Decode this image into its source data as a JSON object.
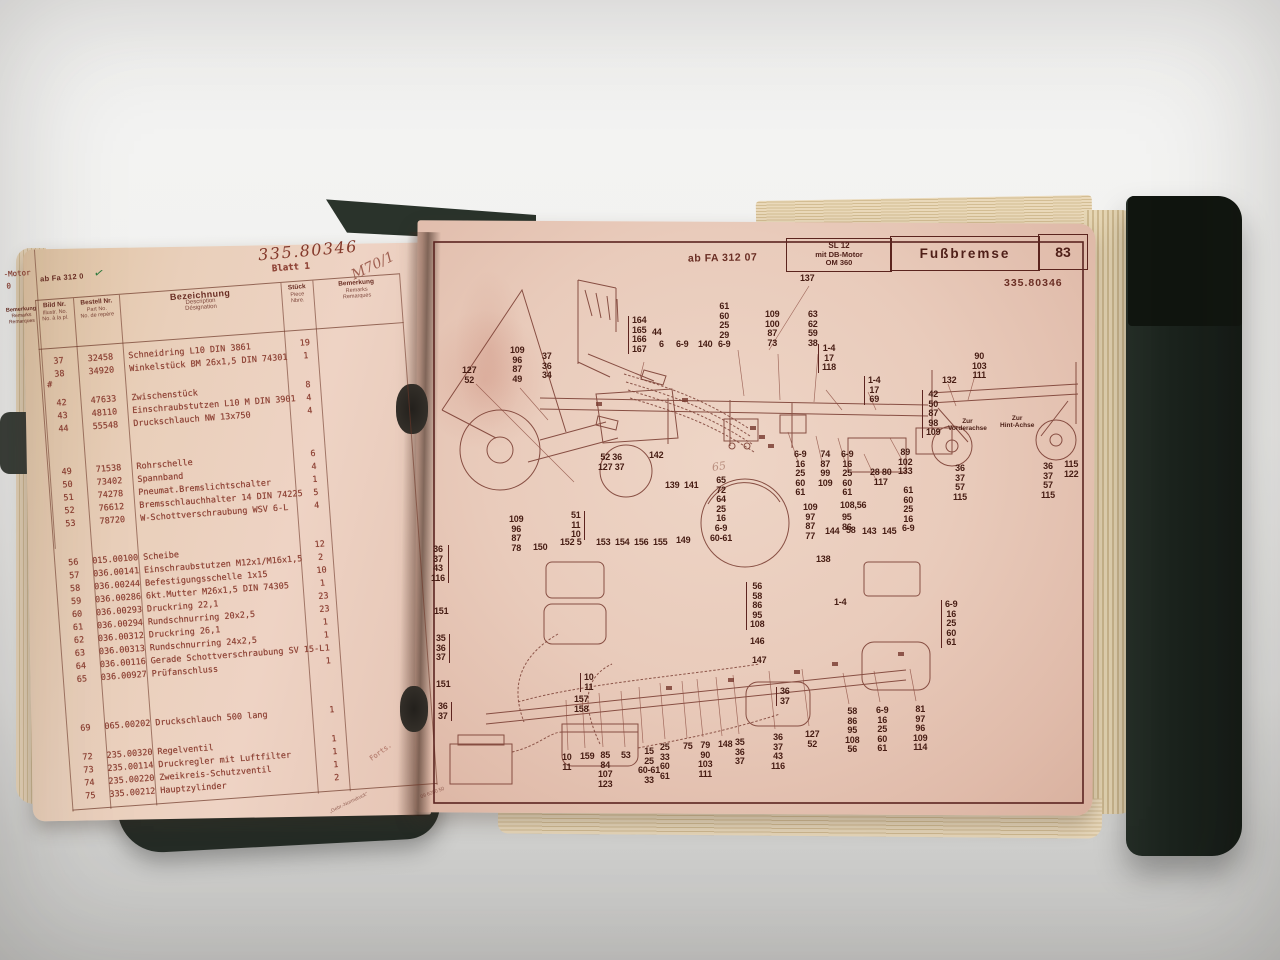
{
  "book": {
    "left_page": {
      "underlay": {
        "motor_fragment": "-Motor",
        "zero_fragment": "0",
        "bem_header": [
          "Bemerkung",
          "Remarks",
          "Remarques"
        ]
      },
      "handwritten_number": "335.80346",
      "sheet": "Blatt 1",
      "stamp": "ab Fa 312 0",
      "check_mark": "✓",
      "note": "M70/1",
      "stray_mark": "#",
      "table": {
        "headers": {
          "bild": [
            "Bild Nr.",
            "Illustr. No.",
            "No. à la pl."
          ],
          "bestell": [
            "Bestell Nr.",
            "Part No.",
            "No. de repère"
          ],
          "bezeichnung": [
            "Bezeichnung",
            "Description",
            "Désignation"
          ],
          "stueck": [
            "Stück",
            "Piece",
            "Nbre."
          ],
          "bemerkung": [
            "Bemerkung",
            "Remarks",
            "Remarques"
          ]
        },
        "rows": [
          {
            "bild": "37",
            "bestell": "32458",
            "name": "Schneidring L10 DIN 3861",
            "qty": "19"
          },
          {
            "bild": "38",
            "bestell": "34920",
            "name": "Winkelstück BM 26x1,5 DIN 74301",
            "qty": "1"
          },
          {
            "bild": "42",
            "bestell": "47633",
            "name": "Zwischenstück",
            "qty": "8",
            "gap": 16
          },
          {
            "bild": "43",
            "bestell": "48110",
            "name": "Einschraubstutzen L10 M DIN 3901",
            "qty": "4"
          },
          {
            "bild": "44",
            "bestell": "55548",
            "name": "Druckschlauch NW 13x750",
            "qty": "4"
          },
          {
            "bild": "49",
            "bestell": "71538",
            "name": "Rohrschelle",
            "qty": "6",
            "gap": 30
          },
          {
            "bild": "50",
            "bestell": "73402",
            "name": "Spannband",
            "qty": "4"
          },
          {
            "bild": "51",
            "bestell": "74278",
            "name": "Pneumat.Bremslichtschalter",
            "qty": "1"
          },
          {
            "bild": "52",
            "bestell": "76612",
            "name": "Bremsschlauchhalter 14 DIN 74225",
            "qty": "5"
          },
          {
            "bild": "53",
            "bestell": "78720",
            "name": "W-Schottverschraubung WSV 6-L",
            "qty": "4"
          },
          {
            "bild": "56",
            "bestell": "015.00100",
            "name": "Scheibe",
            "qty": "12",
            "gap": 26
          },
          {
            "bild": "57",
            "bestell": "036.00141",
            "name": "Einschraubstutzen M12x1/M16x1,5",
            "qty": "2"
          },
          {
            "bild": "58",
            "bestell": "036.00244",
            "name": "Befestigungsschelle 1x15",
            "qty": "10"
          },
          {
            "bild": "59",
            "bestell": "036.00286",
            "name": "6kt.Mutter M26x1,5 DIN 74305",
            "qty": "1"
          },
          {
            "bild": "60",
            "bestell": "036.00293",
            "name": "Druckring 22,1",
            "qty": "23"
          },
          {
            "bild": "61",
            "bestell": "036.00294",
            "name": "Rundschnurring 20x2,5",
            "qty": "23"
          },
          {
            "bild": "62",
            "bestell": "036.00312",
            "name": "Druckring 26,1",
            "qty": "1"
          },
          {
            "bild": "63",
            "bestell": "036.00313",
            "name": "Rundschnurring 24x2,5",
            "qty": "1"
          },
          {
            "bild": "64",
            "bestell": "036.00116",
            "name": "Gerade Schottverschraubung SV 15-L",
            "qty": "1"
          },
          {
            "bild": "65",
            "bestell": "036.00927",
            "name": "Prüfanschluss",
            "qty": "1"
          },
          {
            "bild": "69",
            "bestell": "065.00202",
            "name": "Druckschlauch 500 lang",
            "qty": "1",
            "gap": 36
          },
          {
            "bild": "72",
            "bestell": "235.00320",
            "name": "Regelventil",
            "qty": "1",
            "gap": 16
          },
          {
            "bild": "73",
            "bestell": "235.00114",
            "name": "Druckregler mit Luftfilter",
            "qty": "1"
          },
          {
            "bild": "74",
            "bestell": "235.00220",
            "name": "Zweikreis-Schutzventil",
            "qty": "1"
          },
          {
            "bild": "75",
            "bestell": "335.00212",
            "name": "Hauptzylinder",
            "qty": "2"
          }
        ]
      },
      "footer": {
        "continuation": "Forts.",
        "print_name": "„Gebr.-Normdruck“",
        "print_code": "09 6280 50"
      }
    },
    "right_page": {
      "stamp": "ab FA 312 07",
      "model_box": [
        "SL 12",
        "mit DB-Motor",
        "OM 360"
      ],
      "title": "Fußbremse",
      "page_number": "83",
      "doc_number": "335.80346",
      "diagram": {
        "ghost_note": "65",
        "axle_labels": [
          {
            "x": 520,
            "y": 186,
            "lines": [
              "Zur",
              "Vorderachse"
            ]
          },
          {
            "x": 572,
            "y": 183,
            "lines": [
              "Zur",
              "Hint-Achse"
            ]
          }
        ],
        "callouts": [
          {
            "x": 372,
            "y": 42,
            "lines": [
              "137"
            ]
          },
          {
            "x": 290,
            "y": 70,
            "lines": [
              "61",
              "60",
              "25",
              "29",
              "6-9"
            ]
          },
          {
            "x": 337,
            "y": 78,
            "lines": [
              "109",
              "100",
              "87",
              "73"
            ]
          },
          {
            "x": 380,
            "y": 78,
            "lines": [
              "63",
              "62",
              "59",
              "38"
            ]
          },
          {
            "x": 200,
            "y": 84,
            "lines": [
              "164",
              "165",
              "166",
              "167"
            ],
            "br": "left"
          },
          {
            "x": 224,
            "y": 96,
            "lines": [
              "44"
            ]
          },
          {
            "x": 231,
            "y": 108,
            "lines": [
              "6"
            ]
          },
          {
            "x": 248,
            "y": 108,
            "lines": [
              "6-9"
            ]
          },
          {
            "x": 270,
            "y": 108,
            "lines": [
              "140"
            ]
          },
          {
            "x": 82,
            "y": 114,
            "lines": [
              "109",
              "96",
              "87",
              "49"
            ]
          },
          {
            "x": 114,
            "y": 120,
            "lines": [
              "37",
              "36",
              "34"
            ]
          },
          {
            "x": 34,
            "y": 134,
            "lines": [
              "127",
              "52"
            ]
          },
          {
            "x": 390,
            "y": 112,
            "lines": [
              "1-4",
              "17",
              "118"
            ],
            "br": "left"
          },
          {
            "x": 436,
            "y": 144,
            "lines": [
              "1-4",
              "17",
              "69"
            ],
            "br": "left"
          },
          {
            "x": 544,
            "y": 120,
            "lines": [
              "90",
              "103",
              "111"
            ]
          },
          {
            "x": 514,
            "y": 144,
            "lines": [
              "132"
            ]
          },
          {
            "x": 494,
            "y": 158,
            "lines": [
              "42",
              "50",
              "87",
              "98",
              "109"
            ],
            "br": "left"
          },
          {
            "x": 366,
            "y": 218,
            "lines": [
              "6-9",
              "16",
              "25",
              "60",
              "61"
            ]
          },
          {
            "x": 390,
            "y": 218,
            "lines": [
              "74",
              "87",
              "99",
              "109"
            ]
          },
          {
            "x": 413,
            "y": 218,
            "lines": [
              "6-9",
              "16",
              "25",
              "60",
              "61"
            ]
          },
          {
            "x": 442,
            "y": 236,
            "lines": [
              "28 80",
              "117"
            ]
          },
          {
            "x": 470,
            "y": 216,
            "lines": [
              "89",
              "102",
              "133"
            ]
          },
          {
            "x": 170,
            "y": 221,
            "lines": [
              "52 36",
              "127 37"
            ]
          },
          {
            "x": 221,
            "y": 219,
            "lines": [
              "142"
            ]
          },
          {
            "x": 237,
            "y": 249,
            "lines": [
              "139  141"
            ]
          },
          {
            "x": 282,
            "y": 244,
            "lines": [
              "65",
              "72",
              "64",
              "25",
              "16",
              "6-9",
              "60-61"
            ]
          },
          {
            "x": 474,
            "y": 254,
            "lines": [
              "61",
              "60",
              "25",
              "16",
              "6-9"
            ]
          },
          {
            "x": 375,
            "y": 271,
            "lines": [
              "109",
              "97",
              "87",
              "77"
            ]
          },
          {
            "x": 412,
            "y": 269,
            "lines": [
              "108,56"
            ]
          },
          {
            "x": 414,
            "y": 281,
            "lines": [
              "95",
              "86"
            ]
          },
          {
            "x": 397,
            "y": 295,
            "lines": [
              "144"
            ]
          },
          {
            "x": 418,
            "y": 294,
            "lines": [
              "58"
            ]
          },
          {
            "x": 434,
            "y": 295,
            "lines": [
              "143"
            ]
          },
          {
            "x": 454,
            "y": 295,
            "lines": [
              "145"
            ]
          },
          {
            "x": 143,
            "y": 279,
            "lines": [
              "51",
              "11",
              "10"
            ],
            "br": "right"
          },
          {
            "x": 105,
            "y": 311,
            "lines": [
              "150"
            ]
          },
          {
            "x": 132,
            "y": 306,
            "lines": [
              "152 5"
            ]
          },
          {
            "x": 168,
            "y": 306,
            "lines": [
              "153  154  156  155"
            ]
          },
          {
            "x": 248,
            "y": 304,
            "lines": [
              "149"
            ]
          },
          {
            "x": 81,
            "y": 283,
            "lines": [
              "109",
              "96",
              "87",
              "78"
            ]
          },
          {
            "x": 3,
            "y": 313,
            "lines": [
              "36",
              "37",
              "43",
              "116"
            ],
            "br": "right"
          },
          {
            "x": 6,
            "y": 375,
            "lines": [
              "151"
            ]
          },
          {
            "x": 8,
            "y": 402,
            "lines": [
              "35",
              "36",
              "37"
            ],
            "br": "right"
          },
          {
            "x": 8,
            "y": 448,
            "lines": [
              "151"
            ]
          },
          {
            "x": 10,
            "y": 470,
            "lines": [
              "36",
              "37"
            ],
            "br": "right"
          },
          {
            "x": 388,
            "y": 323,
            "lines": [
              "138"
            ]
          },
          {
            "x": 318,
            "y": 350,
            "lines": [
              "56",
              "58",
              "86",
              "95",
              "108"
            ],
            "br": "left"
          },
          {
            "x": 406,
            "y": 366,
            "lines": [
              "1-4"
            ]
          },
          {
            "x": 513,
            "y": 368,
            "lines": [
              "6-9",
              "16",
              "25",
              "60",
              "61"
            ],
            "br": "left"
          },
          {
            "x": 322,
            "y": 405,
            "lines": [
              "146"
            ]
          },
          {
            "x": 324,
            "y": 424,
            "lines": [
              "147"
            ]
          },
          {
            "x": 152,
            "y": 441,
            "lines": [
              "10",
              "11"
            ],
            "br": "left"
          },
          {
            "x": 146,
            "y": 463,
            "lines": [
              "157",
              "158"
            ]
          },
          {
            "x": 348,
            "y": 455,
            "lines": [
              "36",
              "37"
            ],
            "br": "left"
          },
          {
            "x": 134,
            "y": 521,
            "lines": [
              "10",
              "11"
            ]
          },
          {
            "x": 152,
            "y": 520,
            "lines": [
              "159"
            ]
          },
          {
            "x": 170,
            "y": 519,
            "lines": [
              "85",
              "84",
              "107",
              "123"
            ]
          },
          {
            "x": 193,
            "y": 519,
            "lines": [
              "53"
            ]
          },
          {
            "x": 210,
            "y": 515,
            "lines": [
              "15",
              "25",
              "60-61",
              "33"
            ]
          },
          {
            "x": 232,
            "y": 511,
            "lines": [
              "25",
              "33",
              "60",
              "61"
            ]
          },
          {
            "x": 255,
            "y": 510,
            "lines": [
              "75"
            ]
          },
          {
            "x": 270,
            "y": 509,
            "lines": [
              "79",
              "90",
              "103",
              "111"
            ]
          },
          {
            "x": 290,
            "y": 508,
            "lines": [
              "148"
            ]
          },
          {
            "x": 307,
            "y": 506,
            "lines": [
              "35",
              "36",
              "37"
            ]
          },
          {
            "x": 343,
            "y": 501,
            "lines": [
              "36",
              "37",
              "43",
              "116"
            ]
          },
          {
            "x": 377,
            "y": 498,
            "lines": [
              "127",
              "52"
            ]
          },
          {
            "x": 417,
            "y": 475,
            "lines": [
              "58",
              "86",
              "95",
              "108",
              "56"
            ]
          },
          {
            "x": 448,
            "y": 474,
            "lines": [
              "6-9",
              "16",
              "25",
              "60",
              "61"
            ]
          },
          {
            "x": 485,
            "y": 473,
            "lines": [
              "81",
              "97",
              "96",
              "109",
              "114"
            ]
          },
          {
            "x": 525,
            "y": 232,
            "lines": [
              "36",
              "37",
              "57",
              "115"
            ]
          },
          {
            "x": 613,
            "y": 230,
            "lines": [
              "36",
              "37",
              "57",
              "115"
            ]
          },
          {
            "x": 636,
            "y": 228,
            "lines": [
              "115",
              "122"
            ]
          }
        ]
      }
    }
  }
}
